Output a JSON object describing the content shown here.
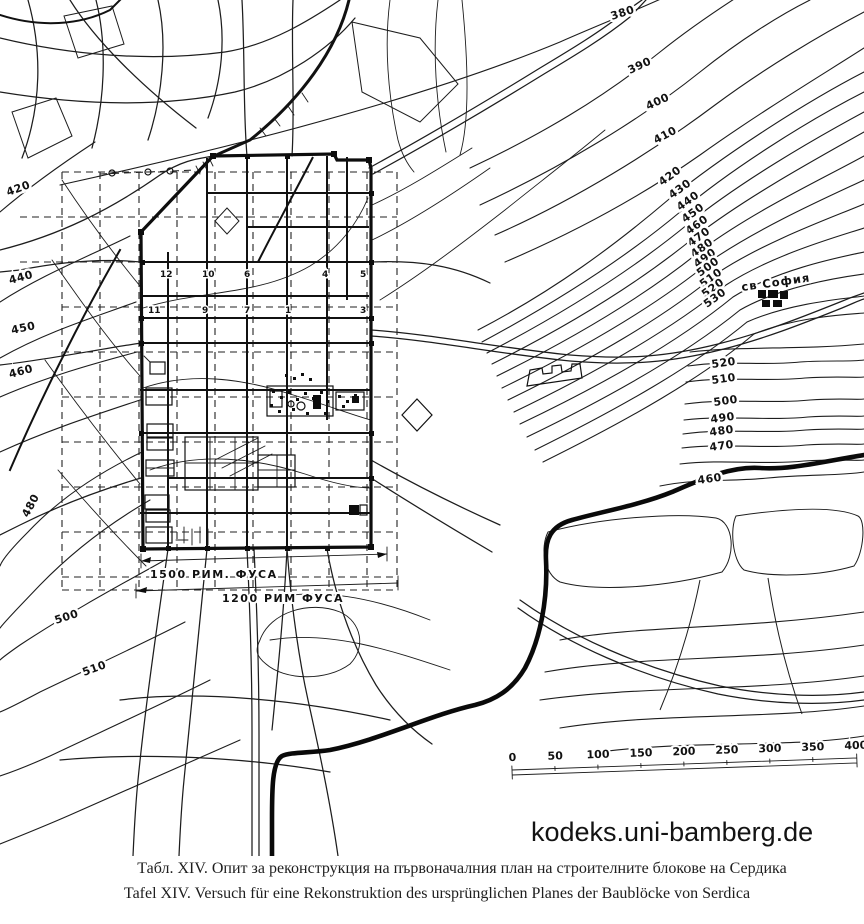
{
  "map": {
    "top_contour_labels": [
      "380",
      "390",
      "400",
      "410"
    ],
    "stack_contour_labels": [
      "420",
      "430",
      "440",
      "450",
      "460",
      "470",
      "480",
      "490",
      "500",
      "510",
      "520",
      "530"
    ],
    "right_contour_labels": [
      "520",
      "510",
      "500",
      "490",
      "480",
      "470",
      "460"
    ],
    "west_contour_labels": [
      "420",
      "440",
      "450",
      "460",
      "480",
      "500",
      "510"
    ],
    "church_label": "св София",
    "block_numbers": {
      "row1": [
        "12",
        "10",
        "6",
        "4",
        "5"
      ],
      "row2": [
        "11",
        "9",
        "7",
        "1",
        "3"
      ]
    },
    "dimensions": {
      "line1": "1500 РИМ. ФУСА",
      "line2": "1200 РИМ ФУСА"
    },
    "scale_bar": {
      "tick_labels": [
        "0",
        "50",
        "100",
        "150",
        "200",
        "250",
        "300",
        "350",
        "400"
      ],
      "unit": "М"
    }
  },
  "watermark": "kodeks.uni-bamberg.de",
  "caption": {
    "line1": "Табл. XIV. Опит за реконструкция на първоначалния план на строителните блокове на Сердика",
    "line2": "Tafel XIV. Versuch für eine Rekonstruktion des ursprünglichen Planes  der Baublöcke von Serdica"
  },
  "colors": {
    "ink": "#1d1d1d",
    "paper": "#ffffff"
  }
}
